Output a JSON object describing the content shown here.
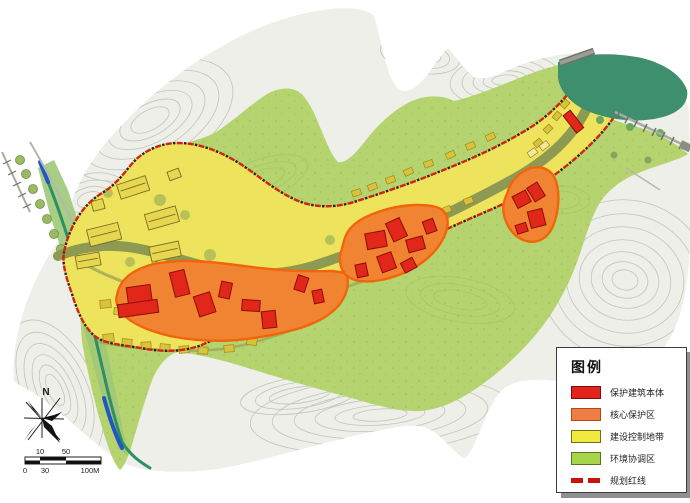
{
  "legend": {
    "title": "图例",
    "items": [
      {
        "label": "保护建筑本体",
        "swatch": "#e3241d",
        "border": "#7d0b08",
        "type": "swatch"
      },
      {
        "label": "核心保护区",
        "swatch": "#ef7e45",
        "border": "#b54a17",
        "type": "swatch"
      },
      {
        "label": "建设控制地带",
        "swatch": "#f2e93f",
        "border": "#6f6f23",
        "type": "swatch"
      },
      {
        "label": "环境协调区",
        "swatch": "#a6d54a",
        "border": "#55742a",
        "type": "swatch"
      },
      {
        "label": "规划红线",
        "swatch": "#c81408",
        "type": "dashed"
      }
    ]
  },
  "compass": {
    "north_label": "N"
  },
  "scale_bar": {
    "top_labels": [
      "10",
      "50"
    ],
    "bottom_labels": [
      "0",
      "30",
      "100M"
    ]
  },
  "map": {
    "colors": {
      "protected_building": "#e1261a",
      "protected_building_border": "#8f0e08",
      "core_protection": "#f08433",
      "core_protection_border": "#f2640a",
      "construction_control": "#ede35c",
      "environment_coordination": "#b5d46f",
      "planning_red_line": "#cf2313",
      "planning_red_line_tick": "#26260f",
      "river_water": "#2f8f63",
      "river_blue": "#2356c5",
      "pond": "#3e8f6d",
      "village_street": "#8e9a52",
      "contour_gray": "#c1c5b8"
    }
  }
}
